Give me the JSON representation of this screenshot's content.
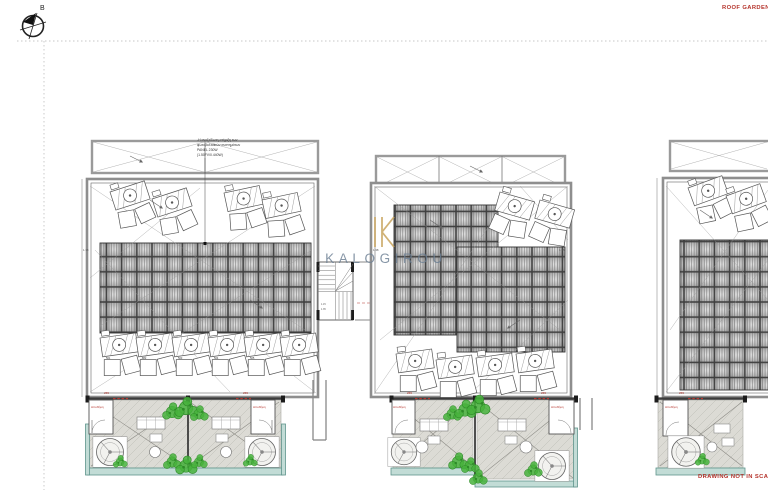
{
  "drawing": {
    "sheet_label": "ROOF GARDEN",
    "scale_note": "DRAWING NOT IN SCALE",
    "north_label": "B"
  },
  "watermark": {
    "brand": "KALOGIROU"
  },
  "annotation": {
    "lines": [
      "-Η ανοξείδωτη στήριξη των",
      "φωτοβολταϊκών συστημάτων",
      "PANEL 230W",
      "(1.50FV/0.440W)"
    ]
  },
  "labels": {
    "storage": "Αποθήκη",
    "door_tag": "255",
    "dim": "1.38",
    "stair_dim_a": "1.15",
    "stair_dim_b": "1.35"
  },
  "ac_units": {
    "numbers": [
      "501",
      "502",
      "503",
      "504",
      "505",
      "506"
    ]
  },
  "colors": {
    "accent_red": "#b5342c",
    "gold": "#c8a45e",
    "brand_text": "#6d8094",
    "plant_green": "#46b13c",
    "plant_dark": "#2e8a28",
    "teal_stroke": "#5f948c",
    "teal_fill": "#c2dcd6",
    "floor": "#dcdbd5"
  }
}
